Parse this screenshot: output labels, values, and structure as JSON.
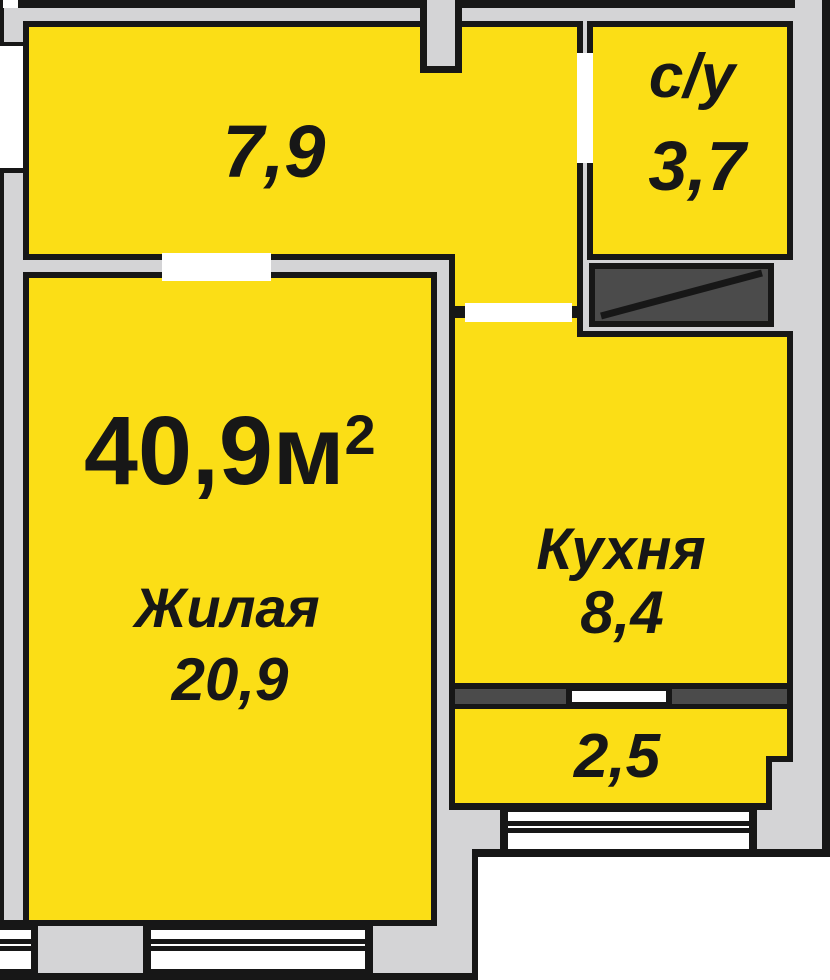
{
  "plan": {
    "rooms": {
      "hallway": {
        "area": "7,9"
      },
      "bathroom": {
        "name": "с/у",
        "area": "3,7"
      },
      "living": {
        "name": "Жилая",
        "area": "20,9"
      },
      "kitchen": {
        "name": "Кухня",
        "area": "8,4"
      },
      "balcony": {
        "area": "2,5"
      }
    },
    "total_area": {
      "main": "40,9м",
      "sup": "2",
      "display": "40,9м²"
    }
  },
  "colors": {
    "room_fill": "#fbde16",
    "wall_fill": "#d4d4d6",
    "outline": "#171717",
    "shaft_fill": "#4b4b4b",
    "background": "#ffffff"
  }
}
